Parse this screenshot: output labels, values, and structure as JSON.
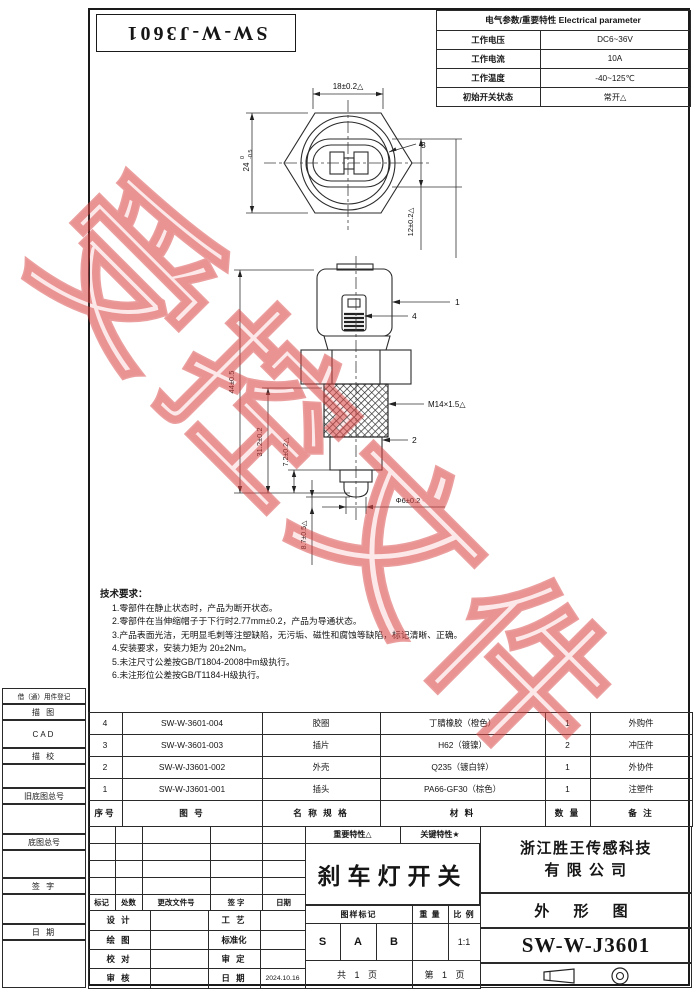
{
  "watermark": {
    "text": "受控文件"
  },
  "corner_title": {
    "text": "SW-W-J3601"
  },
  "electrical": {
    "header": "电气参数/重要特性 Electrical parameter",
    "rows": [
      {
        "label": "工作电压",
        "value": "DC6~36V"
      },
      {
        "label": "工作电流",
        "value": "10A"
      },
      {
        "label": "工作温度",
        "value": "-40~125℃"
      },
      {
        "label": "初始开关状态",
        "value": "常开△"
      }
    ]
  },
  "top_view": {
    "dim_top": "18±0.2△",
    "dim_left_main": "24",
    "dim_left_tol_top": "0",
    "dim_left_tol_bot": "-0.5",
    "callout": "3",
    "dim_right": "12±0.2△"
  },
  "front_view": {
    "dim_overall": "44±0.5",
    "dim_mid": "31.2±0.2",
    "dim_small": "7.2±0.2△",
    "dim_travel": "8.7±0.5△",
    "dim_tip": "Φ6±0.2",
    "thread": "M14×1.5△",
    "callout_housing": "1",
    "callout_body": "2",
    "callout_spring": "4"
  },
  "tech_notes": {
    "title": "技术要求：",
    "items": [
      "1.零部件在静止状态时，产品为断开状态。",
      "2.零部件在当伸缩帽子于下行时2.77mm±0.2，产品为导通状态。",
      "3.产品表面光洁，无明显毛刺等注塑缺陷，无污垢、磁性和腐蚀等缺陷，标记清晰、正确。",
      "4.安装要求，安装力矩为 20±2Nm。",
      "5.未注尺寸公差按GB/T1804-2008中m级执行。",
      "6.未注形位公差按GB/T1184-H级执行。"
    ]
  },
  "margin_labels": {
    "borrow": "借（通）用件登记",
    "trace": "描 图",
    "cad": "CAD",
    "trace_check": "描 校",
    "old_no": "旧底图总号",
    "base_no": "底图总号",
    "sign": "签 字",
    "date": "日 期"
  },
  "bom": {
    "headers": [
      "序号",
      "图    号",
      "名 称 规 格",
      "材    料",
      "数 量",
      "备  注"
    ],
    "rows": [
      [
        "4",
        "SW-W-3601-004",
        "胶圈",
        "丁腈橡胶（橙色）",
        "1",
        "外购件"
      ],
      [
        "3",
        "SW-W-3601-003",
        "插片",
        "H62（镀镍）",
        "2",
        "冲压件"
      ],
      [
        "2",
        "SW-W-J3601-002",
        "外壳",
        "Q235（镀白锌）",
        "1",
        "外协件"
      ],
      [
        "1",
        "SW-W-J3601-001",
        "插头",
        "PA66-GF30（棕色）",
        "1",
        "注塑件"
      ]
    ]
  },
  "title_block": {
    "feature_important": "重要特性△",
    "feature_key": "关键特性★",
    "part_name": "刹车灯开关",
    "company_line1": "浙江胜王传感科技",
    "company_line2": "有 限 公 司",
    "drawing_type": "外 形 图",
    "drawing_no": "SW-W-J3601",
    "mark_label": "图样标记",
    "weight_label": "重 量",
    "scale_label": "比 例",
    "scale_value": "1:1",
    "marks": [
      "S",
      "A",
      "B"
    ],
    "pages_total": "共 1 页",
    "pages_no": "第 1 页",
    "rev_headers": [
      "标记",
      "处数",
      "更改文件号",
      "签 字",
      "日期"
    ],
    "sign_rows": [
      {
        "l": "设 计",
        "r": "工 艺",
        "v": ""
      },
      {
        "l": "绘 图",
        "r": "标准化",
        "v": ""
      },
      {
        "l": "校 对",
        "r": "审 定",
        "v": ""
      },
      {
        "l": "审 核",
        "r": "日 期",
        "v": "2024.10.16"
      }
    ]
  }
}
